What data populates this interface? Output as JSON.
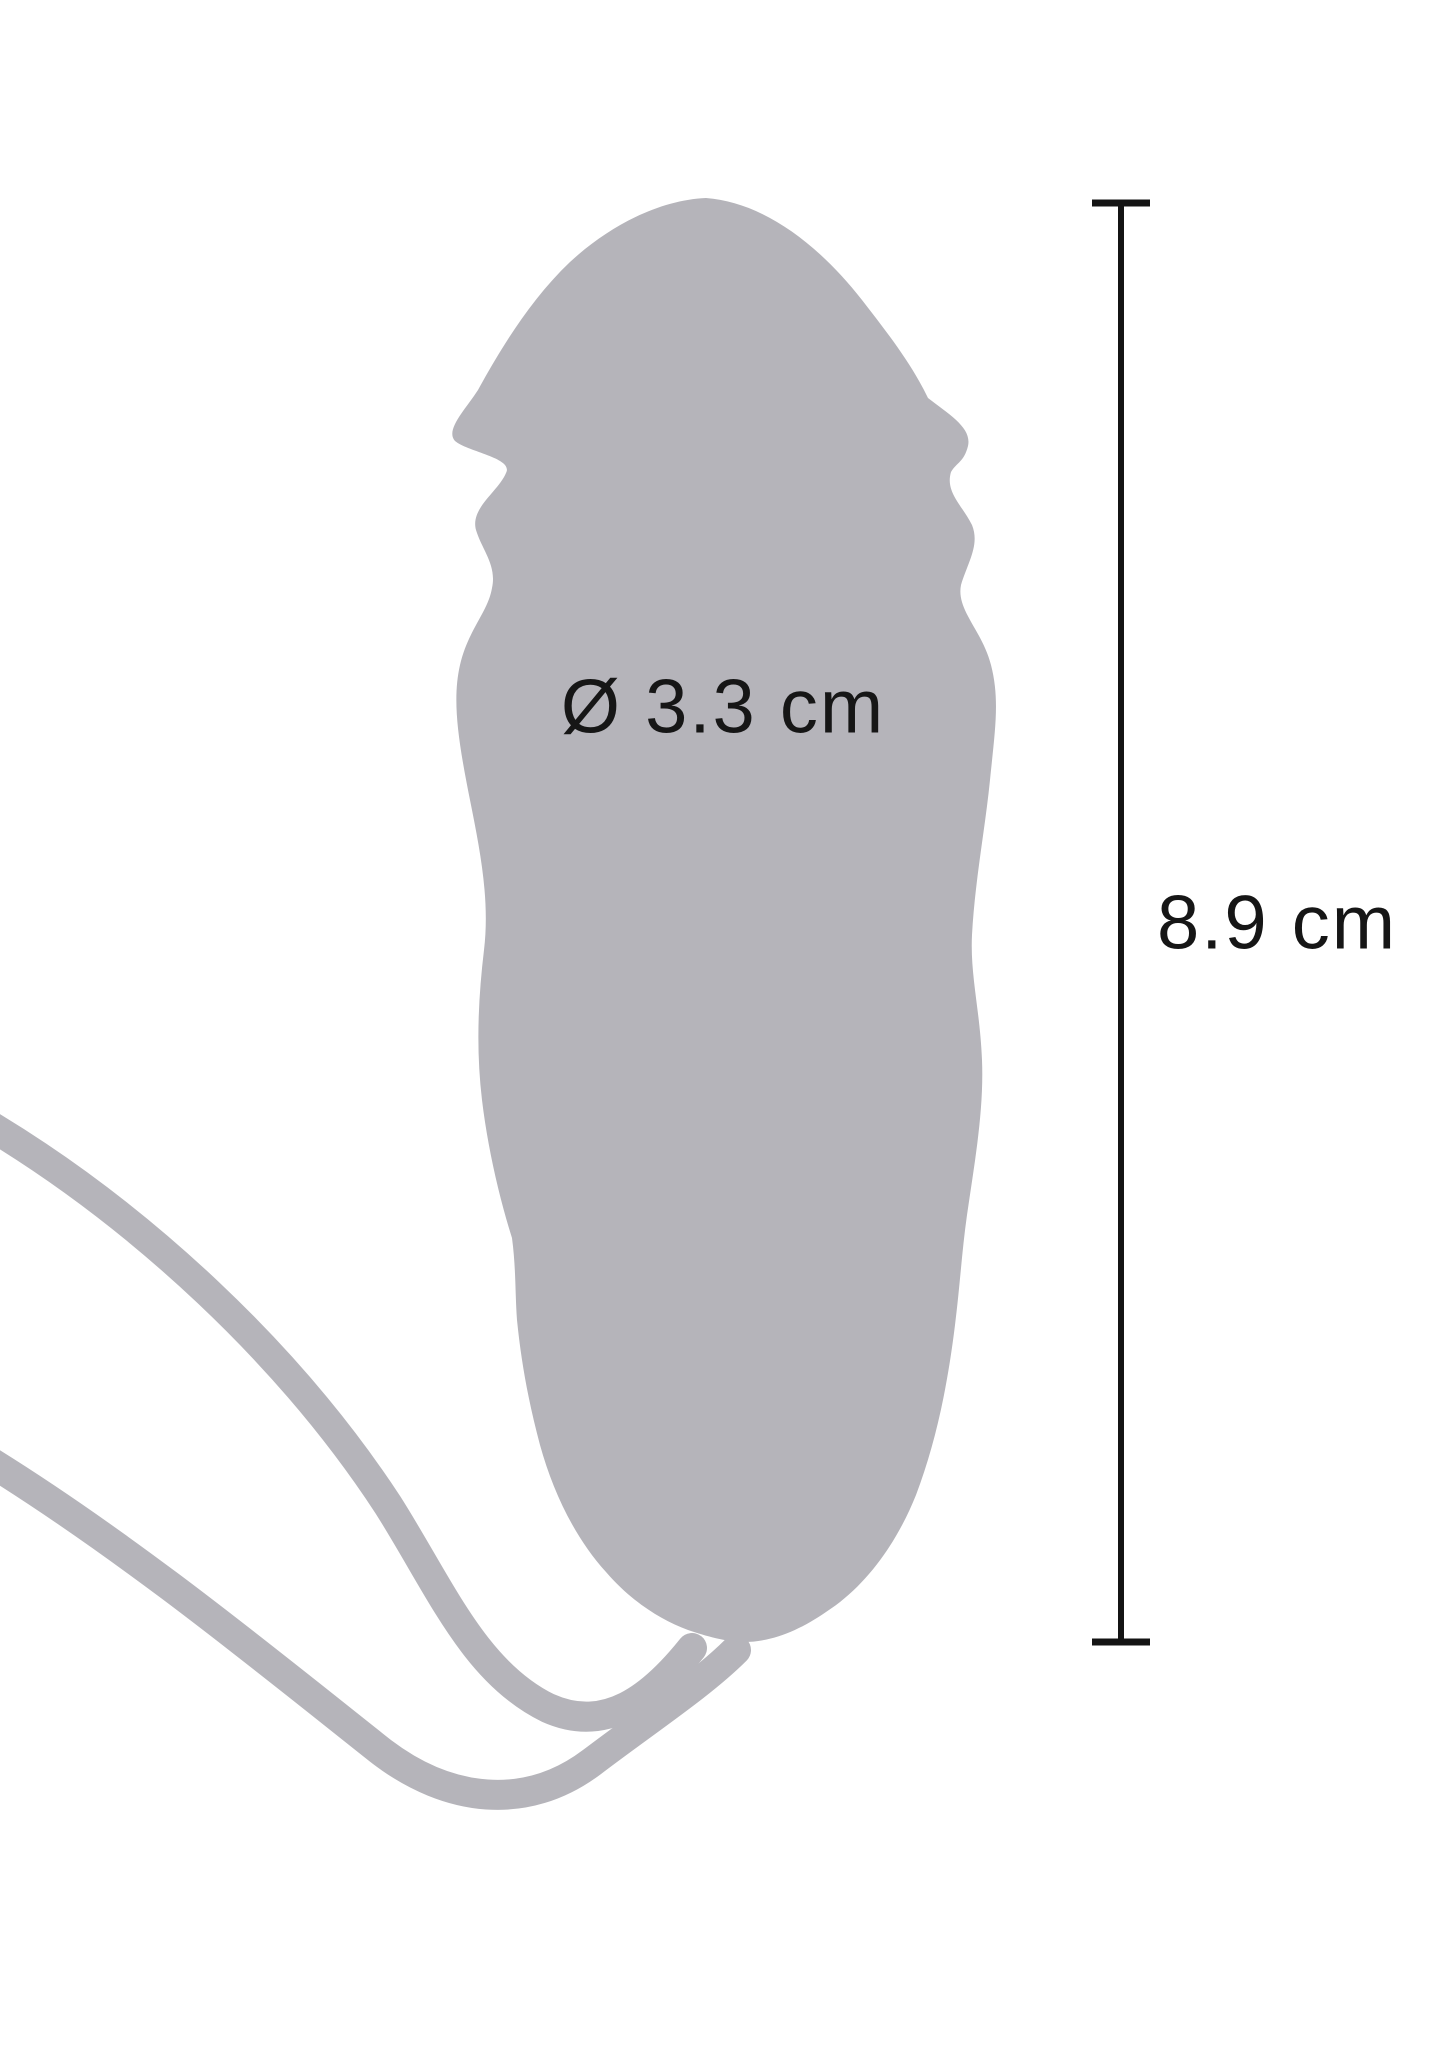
{
  "page": {
    "background": "#ffffff"
  },
  "diagram": {
    "type": "product-dimensions",
    "silhouette_color": "#b5b4ba",
    "text_color": "#161616",
    "line_color": "#141414",
    "diameter_label": "Ø 3.3 cm",
    "length_label": "8.9 cm",
    "diameter_cm": 3.3,
    "length_cm": 8.9
  }
}
